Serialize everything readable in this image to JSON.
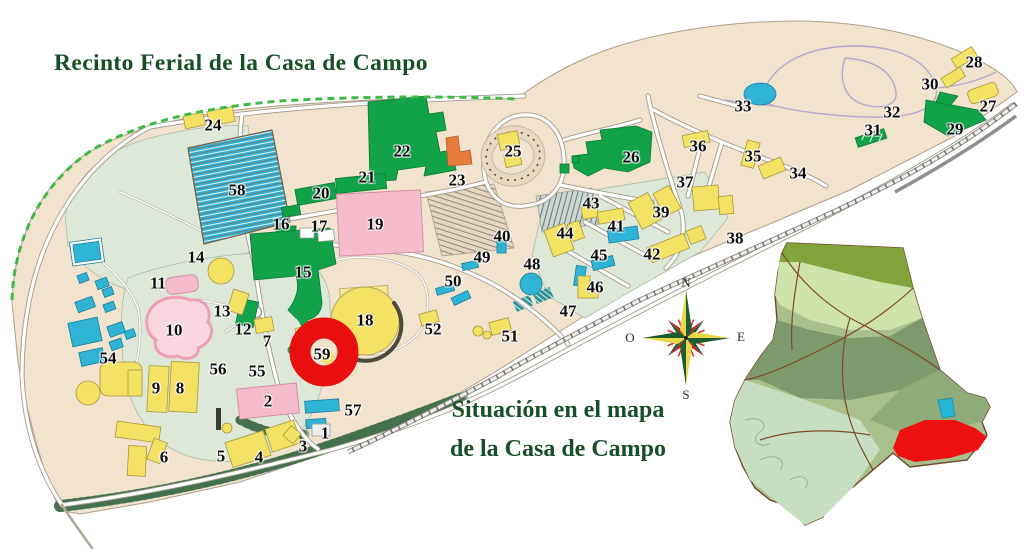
{
  "title": "Recinto Ferial de la Casa de Campo",
  "inset": {
    "caption_line1": "Situación en el mapa",
    "caption_line2": "de la Casa de Campo"
  },
  "compass": {
    "north": "N",
    "south": "S",
    "east": "E",
    "west": "O"
  },
  "colors": {
    "title_green": "#174f28",
    "land_beige": "#f2e3cf",
    "park_green": "#dde8d8",
    "building_yellow": "#f3e263",
    "building_cyan": "#2fb4d6",
    "building_green": "#12a24a",
    "building_pink": "#f6bccb",
    "building_orange": "#e87c3e",
    "marker_red": "#e90f0f",
    "boundary_dash_green": "#3fb845"
  },
  "marker": {
    "label": "59"
  },
  "map_labels": [
    {
      "n": "1",
      "x": 325,
      "y": 433
    },
    {
      "n": "2",
      "x": 268,
      "y": 401
    },
    {
      "n": "3",
      "x": 303,
      "y": 446
    },
    {
      "n": "4",
      "x": 259,
      "y": 457
    },
    {
      "n": "5",
      "x": 221,
      "y": 456
    },
    {
      "n": "6",
      "x": 164,
      "y": 457
    },
    {
      "n": "7",
      "x": 267,
      "y": 341
    },
    {
      "n": "8",
      "x": 180,
      "y": 388
    },
    {
      "n": "9",
      "x": 156,
      "y": 388
    },
    {
      "n": "10",
      "x": 174,
      "y": 330
    },
    {
      "n": "11",
      "x": 158,
      "y": 283
    },
    {
      "n": "12",
      "x": 243,
      "y": 329
    },
    {
      "n": "13",
      "x": 222,
      "y": 311
    },
    {
      "n": "14",
      "x": 196,
      "y": 257
    },
    {
      "n": "15",
      "x": 303,
      "y": 272
    },
    {
      "n": "16",
      "x": 281,
      "y": 224
    },
    {
      "n": "17",
      "x": 319,
      "y": 226
    },
    {
      "n": "18",
      "x": 365,
      "y": 320
    },
    {
      "n": "19",
      "x": 375,
      "y": 224
    },
    {
      "n": "20",
      "x": 321,
      "y": 193
    },
    {
      "n": "21",
      "x": 367,
      "y": 177
    },
    {
      "n": "22",
      "x": 402,
      "y": 151
    },
    {
      "n": "23",
      "x": 457,
      "y": 180
    },
    {
      "n": "24",
      "x": 213,
      "y": 125
    },
    {
      "n": "25",
      "x": 513,
      "y": 151
    },
    {
      "n": "26",
      "x": 631,
      "y": 157
    },
    {
      "n": "27",
      "x": 988,
      "y": 106
    },
    {
      "n": "28",
      "x": 974,
      "y": 62
    },
    {
      "n": "29",
      "x": 955,
      "y": 129
    },
    {
      "n": "30",
      "x": 930,
      "y": 84
    },
    {
      "n": "31",
      "x": 873,
      "y": 130
    },
    {
      "n": "32",
      "x": 892,
      "y": 112
    },
    {
      "n": "33",
      "x": 743,
      "y": 106
    },
    {
      "n": "34",
      "x": 798,
      "y": 173
    },
    {
      "n": "35",
      "x": 753,
      "y": 156
    },
    {
      "n": "36",
      "x": 698,
      "y": 146
    },
    {
      "n": "37",
      "x": 685,
      "y": 182
    },
    {
      "n": "38",
      "x": 735,
      "y": 238
    },
    {
      "n": "39",
      "x": 661,
      "y": 212
    },
    {
      "n": "40",
      "x": 502,
      "y": 236
    },
    {
      "n": "41",
      "x": 616,
      "y": 226
    },
    {
      "n": "42",
      "x": 652,
      "y": 254
    },
    {
      "n": "43",
      "x": 591,
      "y": 203
    },
    {
      "n": "44",
      "x": 565,
      "y": 233
    },
    {
      "n": "45",
      "x": 599,
      "y": 255
    },
    {
      "n": "46",
      "x": 595,
      "y": 287
    },
    {
      "n": "47",
      "x": 568,
      "y": 311
    },
    {
      "n": "48",
      "x": 532,
      "y": 264
    },
    {
      "n": "49",
      "x": 482,
      "y": 257
    },
    {
      "n": "50",
      "x": 453,
      "y": 281
    },
    {
      "n": "51",
      "x": 510,
      "y": 336
    },
    {
      "n": "52",
      "x": 433,
      "y": 329
    },
    {
      "n": "54",
      "x": 108,
      "y": 358
    },
    {
      "n": "55",
      "x": 257,
      "y": 371
    },
    {
      "n": "56",
      "x": 218,
      "y": 369
    },
    {
      "n": "57",
      "x": 353,
      "y": 410
    },
    {
      "n": "58",
      "x": 237,
      "y": 190
    },
    {
      "n": "59",
      "x": 322,
      "y": 354,
      "highlight": true
    }
  ]
}
